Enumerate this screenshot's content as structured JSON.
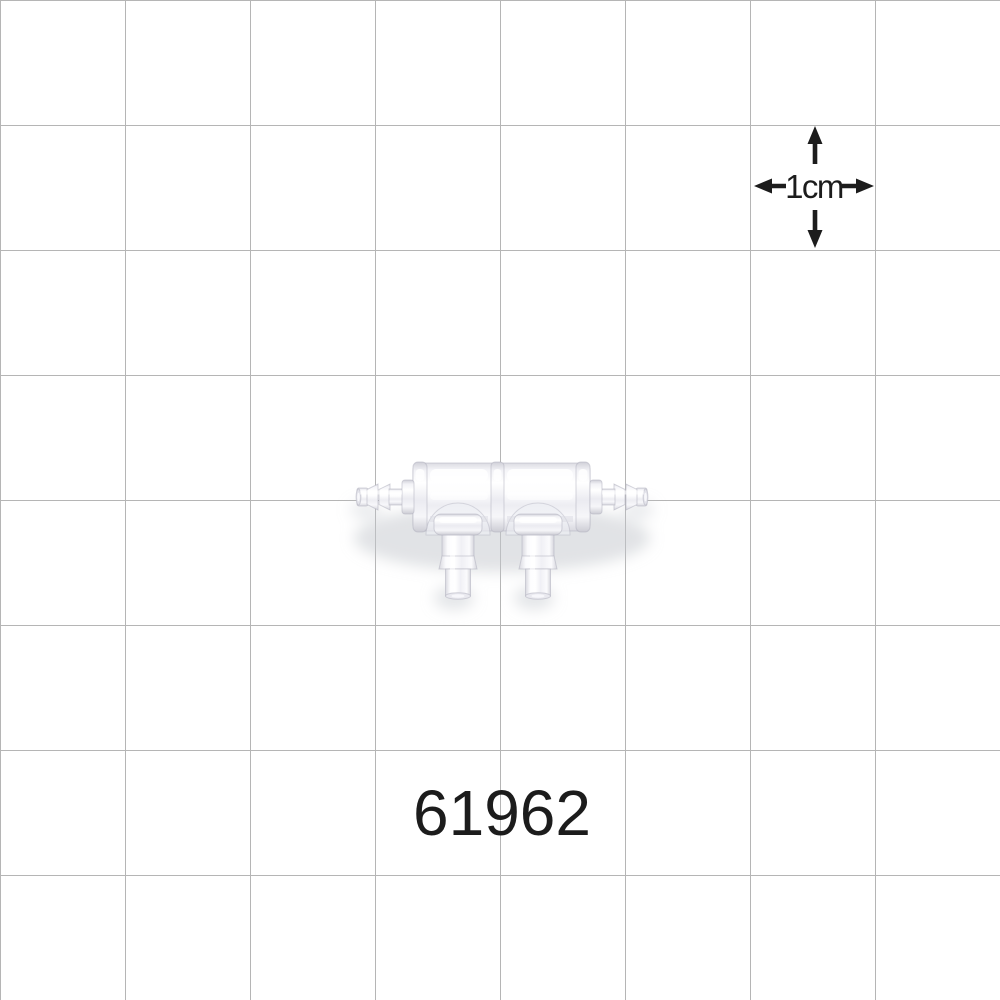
{
  "colors": {
    "background": "#ffffff",
    "grid_line": "#b5b5b5",
    "ink": "#1c1c1c"
  },
  "grid": {
    "cell_px": 125,
    "columns": 8,
    "rows": 8,
    "cell_represents": "1cm"
  },
  "scale_indicator": {
    "label": "1cm"
  },
  "product": {
    "part_number": "61962",
    "image": "translucent four-port barbed tubing manifold, two side barbs and two downward barbs"
  }
}
